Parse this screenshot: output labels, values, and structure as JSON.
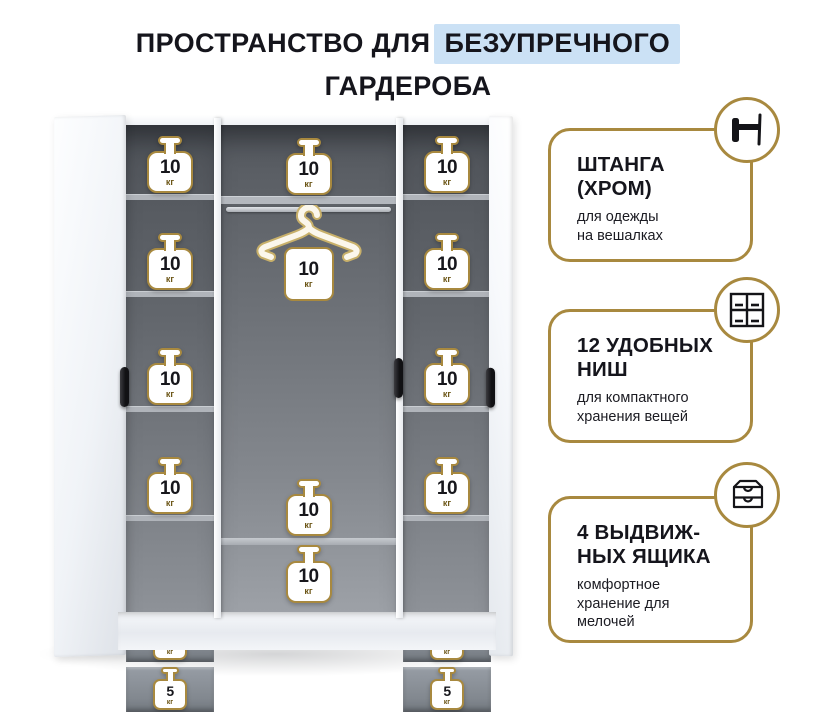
{
  "page": {
    "title_prefix": "ПРОСТРАНСТВО ДЛЯ",
    "title_highlight": "БЕЗУПРЕЧНОГО",
    "title_line2": "ГАРДЕРОБА",
    "colors": {
      "gold": "#a8893f",
      "highlight_blue": "#cbe1f5",
      "text": "#15151c",
      "interior_gray": "#5a5e65"
    }
  },
  "features": [
    {
      "icon": "rod-icon",
      "title": "ШТАНГА\n(ХРОМ)",
      "desc": "для одежды\nна вешалках"
    },
    {
      "icon": "niches-icon",
      "title": "12 УДОБНЫХ\nНИШ",
      "desc": "для компактного\nхранения вещей"
    },
    {
      "icon": "drawers-icon",
      "title": "4 ВЫДВИЖ-\nНЫХ ЯЩИКА",
      "desc": "комфортное\nхранение для\nмелочей"
    }
  ],
  "wardrobe": {
    "unit": "кг",
    "left_shelves": [
      "10",
      "10",
      "10",
      "10"
    ],
    "left_drawers": [
      "5",
      "5"
    ],
    "middle_top": "10",
    "hanger_load": "10",
    "middle_lower": [
      "10",
      "10"
    ],
    "right_shelves": [
      "10",
      "10",
      "10",
      "10"
    ],
    "right_drawers": [
      "5",
      "5"
    ]
  }
}
